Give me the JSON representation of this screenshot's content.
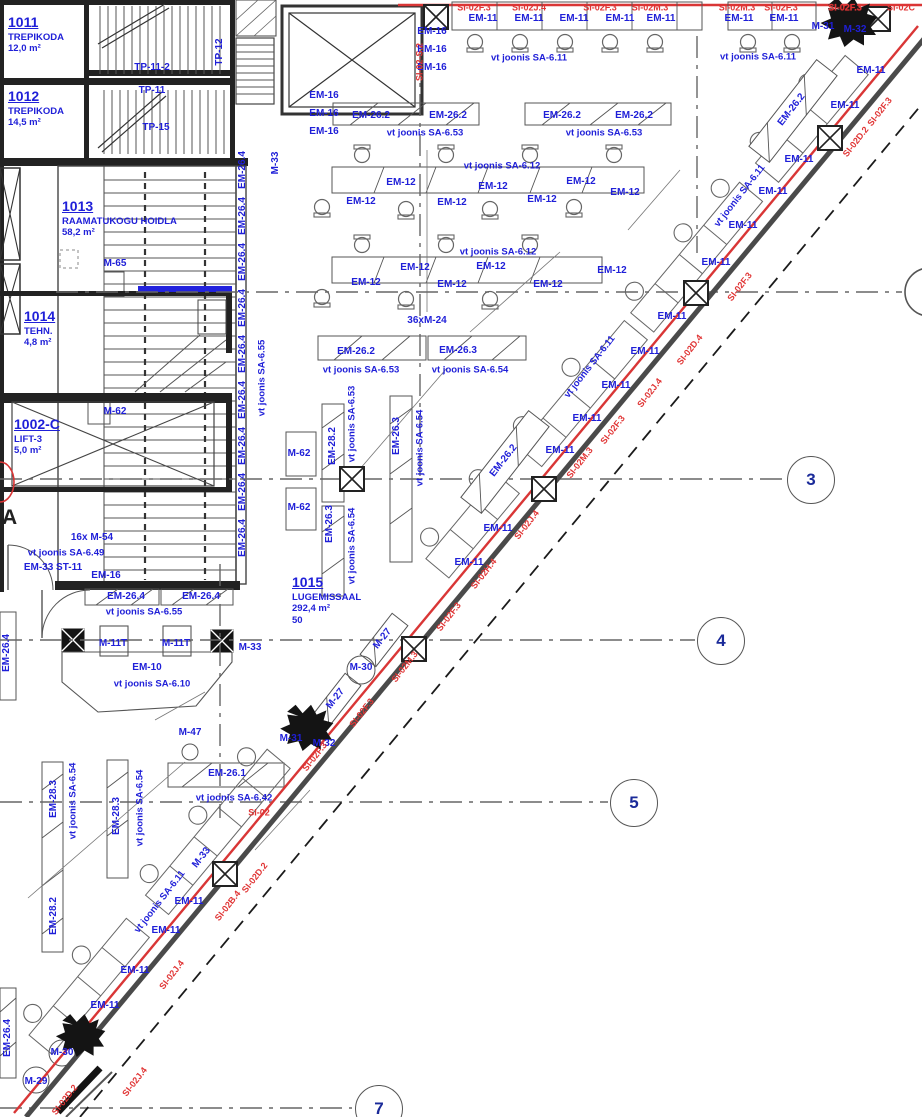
{
  "colors": {
    "blue": "#1f1fd8",
    "red": "#e03434",
    "line": "#444",
    "wall": "#1a1a1a"
  },
  "rooms": [
    {
      "number": "1011",
      "lines": [
        "TREPIKODA",
        "12,0 m²"
      ],
      "x": 8,
      "y": 14
    },
    {
      "number": "1012",
      "lines": [
        "TREPIKODA",
        "14,5 m²"
      ],
      "x": 8,
      "y": 88
    },
    {
      "number": "1013",
      "lines": [
        "RAAMATUKOGU HOIDLA",
        "58,2 m²"
      ],
      "x": 62,
      "y": 198
    },
    {
      "number": "1014",
      "lines": [
        "TEHN.",
        "4,8 m²"
      ],
      "x": 24,
      "y": 308
    },
    {
      "number": "1002-C",
      "lines": [
        "LIFT-3",
        "5,0 m²"
      ],
      "x": 14,
      "y": 416
    },
    {
      "number": "1015",
      "lines": [
        "LUGEMISSAAL",
        "292,4 m²",
        "50"
      ],
      "x": 292,
      "y": 574
    }
  ],
  "equipment_labels": [
    {
      "t": "TP-11-2",
      "x": 152,
      "y": 68
    },
    {
      "t": "TP-11",
      "x": 152,
      "y": 91
    },
    {
      "t": "TP-15",
      "x": 156,
      "y": 128
    },
    {
      "t": "TP-12",
      "x": 220,
      "y": 52,
      "r": -90
    },
    {
      "t": "M-33",
      "x": 276,
      "y": 163,
      "r": -90
    },
    {
      "t": "EM-16",
      "x": 432,
      "y": 32
    },
    {
      "t": "EM-16",
      "x": 432,
      "y": 50
    },
    {
      "t": "EM-16",
      "x": 432,
      "y": 68
    },
    {
      "t": "EM-16",
      "x": 324,
      "y": 96
    },
    {
      "t": "EM-16",
      "x": 324,
      "y": 114
    },
    {
      "t": "EM-16",
      "x": 324,
      "y": 132
    },
    {
      "t": "EM-26.2",
      "x": 371,
      "y": 116
    },
    {
      "t": "EM-26.2",
      "x": 448,
      "y": 116
    },
    {
      "t": "EM-26.2",
      "x": 562,
      "y": 116
    },
    {
      "t": "EM-26.2",
      "x": 634,
      "y": 116
    },
    {
      "t": "EM-12",
      "x": 401,
      "y": 183
    },
    {
      "t": "EM-12",
      "x": 493,
      "y": 187
    },
    {
      "t": "EM-12",
      "x": 581,
      "y": 182
    },
    {
      "t": "EM-12",
      "x": 361,
      "y": 202
    },
    {
      "t": "EM-12",
      "x": 452,
      "y": 203
    },
    {
      "t": "EM-12",
      "x": 542,
      "y": 200
    },
    {
      "t": "EM-12",
      "x": 625,
      "y": 193
    },
    {
      "t": "EM-12",
      "x": 415,
      "y": 268
    },
    {
      "t": "EM-12",
      "x": 491,
      "y": 267
    },
    {
      "t": "EM-12",
      "x": 612,
      "y": 271
    },
    {
      "t": "EM-12",
      "x": 366,
      "y": 283
    },
    {
      "t": "EM-12",
      "x": 452,
      "y": 285
    },
    {
      "t": "EM-12",
      "x": 548,
      "y": 285
    },
    {
      "t": "36xM-24",
      "x": 427,
      "y": 321
    },
    {
      "t": "M-65",
      "x": 115,
      "y": 264
    },
    {
      "t": "M-62",
      "x": 115,
      "y": 412
    },
    {
      "t": "M-62",
      "x": 299,
      "y": 454
    },
    {
      "t": "M-62",
      "x": 299,
      "y": 508
    },
    {
      "t": "EM-26.2",
      "x": 356,
      "y": 352
    },
    {
      "t": "EM-26.3",
      "x": 458,
      "y": 351
    },
    {
      "t": "EM-28.2",
      "x": 333,
      "y": 446,
      "r": -90
    },
    {
      "t": "EM-26.3",
      "x": 330,
      "y": 524,
      "r": -90
    },
    {
      "t": "EM-26.3",
      "x": 397,
      "y": 436,
      "r": -90
    },
    {
      "t": "EM-26.4",
      "x": 243,
      "y": 170,
      "r": -90
    },
    {
      "t": "EM-26.4",
      "x": 243,
      "y": 216,
      "r": -90
    },
    {
      "t": "EM-26.4",
      "x": 243,
      "y": 262,
      "r": -90
    },
    {
      "t": "EM-26.4",
      "x": 243,
      "y": 308,
      "r": -90
    },
    {
      "t": "EM-26.4",
      "x": 243,
      "y": 354,
      "r": -90
    },
    {
      "t": "EM-26.4",
      "x": 243,
      "y": 400,
      "r": -90
    },
    {
      "t": "EM-26.4",
      "x": 243,
      "y": 446,
      "r": -90
    },
    {
      "t": "EM-26.4",
      "x": 243,
      "y": 492,
      "r": -90
    },
    {
      "t": "EM-26.4",
      "x": 243,
      "y": 538,
      "r": -90
    },
    {
      "t": "16x M-54",
      "x": 92,
      "y": 538
    },
    {
      "t": "EM-33 ST-11",
      "x": 53,
      "y": 568
    },
    {
      "t": "EM-16",
      "x": 106,
      "y": 576
    },
    {
      "t": "EM-26.4",
      "x": 126,
      "y": 597
    },
    {
      "t": "EM-26.4",
      "x": 201,
      "y": 597
    },
    {
      "t": "M-11T",
      "x": 113,
      "y": 644
    },
    {
      "t": "M-11T",
      "x": 176,
      "y": 644
    },
    {
      "t": "M-33",
      "x": 250,
      "y": 648
    },
    {
      "t": "EM-10",
      "x": 147,
      "y": 668
    },
    {
      "t": "M-47",
      "x": 190,
      "y": 733
    },
    {
      "t": "EM-26.1",
      "x": 227,
      "y": 774
    },
    {
      "t": "M-30",
      "x": 361,
      "y": 668
    },
    {
      "t": "M-27",
      "x": 383,
      "y": 639,
      "r": -52
    },
    {
      "t": "M-27",
      "x": 336,
      "y": 699,
      "r": -52
    },
    {
      "t": "M-31",
      "x": 291,
      "y": 739
    },
    {
      "t": "M-32",
      "x": 324,
      "y": 744
    },
    {
      "t": "M-33",
      "x": 202,
      "y": 858,
      "r": -52
    },
    {
      "t": "EM-26.4",
      "x": 7,
      "y": 653,
      "r": -90
    },
    {
      "t": "EM-26.4",
      "x": 8,
      "y": 1038,
      "r": -90
    },
    {
      "t": "EM-28.3",
      "x": 54,
      "y": 799,
      "r": -90
    },
    {
      "t": "EM-28.3",
      "x": 117,
      "y": 816,
      "r": -90
    },
    {
      "t": "EM-28.2",
      "x": 54,
      "y": 916,
      "r": -90
    },
    {
      "t": "M-30",
      "x": 62,
      "y": 1053
    },
    {
      "t": "M-29",
      "x": 36,
      "y": 1082
    },
    {
      "t": "M-31",
      "x": 823,
      "y": 27
    },
    {
      "t": "M-32",
      "x": 855,
      "y": 30
    },
    {
      "t": "EM-26.2",
      "x": 792,
      "y": 110,
      "r": -52
    },
    {
      "t": "EM-26.2",
      "x": 504,
      "y": 461,
      "r": -52
    },
    {
      "t": "EM-11",
      "x": 483,
      "y": 19
    },
    {
      "t": "EM-11",
      "x": 529,
      "y": 19
    },
    {
      "t": "EM-11",
      "x": 574,
      "y": 19
    },
    {
      "t": "EM-11",
      "x": 620,
      "y": 19
    },
    {
      "t": "EM-11",
      "x": 661,
      "y": 19
    },
    {
      "t": "EM-11",
      "x": 739,
      "y": 19
    },
    {
      "t": "EM-11",
      "x": 784,
      "y": 19
    },
    {
      "t": "EM-11",
      "x": 871,
      "y": 71
    },
    {
      "t": "EM-11",
      "x": 845,
      "y": 106
    },
    {
      "t": "EM-11",
      "x": 799,
      "y": 160
    },
    {
      "t": "EM-11",
      "x": 773,
      "y": 192
    },
    {
      "t": "EM-11",
      "x": 743,
      "y": 226
    },
    {
      "t": "EM-11",
      "x": 716,
      "y": 263
    },
    {
      "t": "EM-11",
      "x": 672,
      "y": 317
    },
    {
      "t": "EM-11",
      "x": 645,
      "y": 352
    },
    {
      "t": "EM-11",
      "x": 616,
      "y": 386
    },
    {
      "t": "EM-11",
      "x": 587,
      "y": 419
    },
    {
      "t": "EM-11",
      "x": 560,
      "y": 451
    },
    {
      "t": "EM-11",
      "x": 498,
      "y": 529
    },
    {
      "t": "EM-11",
      "x": 469,
      "y": 563
    },
    {
      "t": "EM-11",
      "x": 189,
      "y": 902
    },
    {
      "t": "EM-11",
      "x": 166,
      "y": 931
    },
    {
      "t": "EM-11",
      "x": 135,
      "y": 971
    },
    {
      "t": "EM-11",
      "x": 105,
      "y": 1006
    }
  ],
  "reference_notes": [
    {
      "t": "vt joonis SA-6.11",
      "x": 529,
      "y": 58
    },
    {
      "t": "vt joonis SA-6.11",
      "x": 758,
      "y": 57
    },
    {
      "t": "vt joonis SA-6.53",
      "x": 425,
      "y": 133
    },
    {
      "t": "vt joonis SA-6.53",
      "x": 604,
      "y": 133
    },
    {
      "t": "vt joonis SA-6.12",
      "x": 502,
      "y": 166
    },
    {
      "t": "vt joonis SA-6.12",
      "x": 498,
      "y": 252
    },
    {
      "t": "vt joonis SA-6.53",
      "x": 361,
      "y": 370
    },
    {
      "t": "vt joonis SA-6.54",
      "x": 470,
      "y": 370
    },
    {
      "t": "vt joonis SA-6.53",
      "x": 352,
      "y": 424,
      "r": -90
    },
    {
      "t": "vt joonis SA-6.54",
      "x": 352,
      "y": 546,
      "r": -90
    },
    {
      "t": "vt joonis SA-6.54",
      "x": 420,
      "y": 448,
      "r": -90
    },
    {
      "t": "vt joonis SA-6.55",
      "x": 262,
      "y": 378,
      "r": -90
    },
    {
      "t": "vt joonis SA-6.49",
      "x": 66,
      "y": 553
    },
    {
      "t": "vt joonis SA-6.55",
      "x": 144,
      "y": 612
    },
    {
      "t": "vt joonis SA-6.10",
      "x": 152,
      "y": 684
    },
    {
      "t": "vt joonis SA-6.42",
      "x": 234,
      "y": 798
    },
    {
      "t": "vt joonis SA-6.54",
      "x": 73,
      "y": 801,
      "r": -90
    },
    {
      "t": "vt joonis SA-6.54",
      "x": 140,
      "y": 808,
      "r": -90
    },
    {
      "t": "vt joonis SA-6.11",
      "x": 740,
      "y": 196,
      "r": -52
    },
    {
      "t": "vt joonis SA-6.11",
      "x": 590,
      "y": 367,
      "r": -52
    },
    {
      "t": "vt joonis SA-6.11",
      "x": 160,
      "y": 902,
      "r": -52
    }
  ],
  "fire_codes": [
    {
      "t": "SI-02F.3",
      "x": 474,
      "y": 8
    },
    {
      "t": "SI-02J.4",
      "x": 529,
      "y": 8
    },
    {
      "t": "SI-02F.3",
      "x": 600,
      "y": 8
    },
    {
      "t": "SI-02M.3",
      "x": 650,
      "y": 8
    },
    {
      "t": "SI-02M.3",
      "x": 737,
      "y": 8
    },
    {
      "t": "SI-02F.3",
      "x": 781,
      "y": 8
    },
    {
      "t": "SI-02F.3",
      "x": 845,
      "y": 8,
      "b": 1
    },
    {
      "t": "SI-02C",
      "x": 901,
      "y": 8
    },
    {
      "t": "SI-02-S.2",
      "x": 420,
      "y": 62,
      "r": -90
    },
    {
      "t": "SI-02",
      "x": 259,
      "y": 813
    },
    {
      "t": "SI-02F.3",
      "x": 880,
      "y": 112,
      "r": -52
    },
    {
      "t": "SI-02D.2",
      "x": 856,
      "y": 142,
      "r": -52
    },
    {
      "t": "SI-02F.3",
      "x": 740,
      "y": 287,
      "r": -52
    },
    {
      "t": "SI-02D.4",
      "x": 690,
      "y": 350,
      "r": -52
    },
    {
      "t": "SI-02J.4",
      "x": 650,
      "y": 393,
      "r": -52
    },
    {
      "t": "SI-02F.3",
      "x": 613,
      "y": 430,
      "r": -52
    },
    {
      "t": "SI-02M.3",
      "x": 580,
      "y": 463,
      "r": -52
    },
    {
      "t": "SI-02J.4",
      "x": 527,
      "y": 525,
      "r": -52
    },
    {
      "t": "SI-02H.4",
      "x": 484,
      "y": 574,
      "r": -52
    },
    {
      "t": "SI-02F.3",
      "x": 449,
      "y": 617,
      "r": -52
    },
    {
      "t": "SI-02M.3",
      "x": 405,
      "y": 667,
      "r": -52
    },
    {
      "t": "SI-02F.3",
      "x": 362,
      "y": 713,
      "r": -52
    },
    {
      "t": "SI-02F.3",
      "x": 315,
      "y": 757,
      "r": -52
    },
    {
      "t": "SI-02D.2",
      "x": 255,
      "y": 878,
      "r": -52
    },
    {
      "t": "SI-02B.4",
      "x": 228,
      "y": 906,
      "r": -52
    },
    {
      "t": "SI-02J.4",
      "x": 172,
      "y": 975,
      "r": -52
    },
    {
      "t": "SI-02J.4",
      "x": 135,
      "y": 1082,
      "r": -52
    },
    {
      "t": "SI-02D.2",
      "x": 65,
      "y": 1100,
      "r": -52
    }
  ],
  "grid_bubbles": [
    {
      "label": "3",
      "x": 810,
      "y": 479
    },
    {
      "label": "4",
      "x": 720,
      "y": 640
    },
    {
      "label": "5",
      "x": 633,
      "y": 802
    },
    {
      "label": "7",
      "x": 378,
      "y": 1108
    }
  ],
  "grid_letters": [
    {
      "label": "A",
      "x": 2,
      "y": 506
    }
  ]
}
